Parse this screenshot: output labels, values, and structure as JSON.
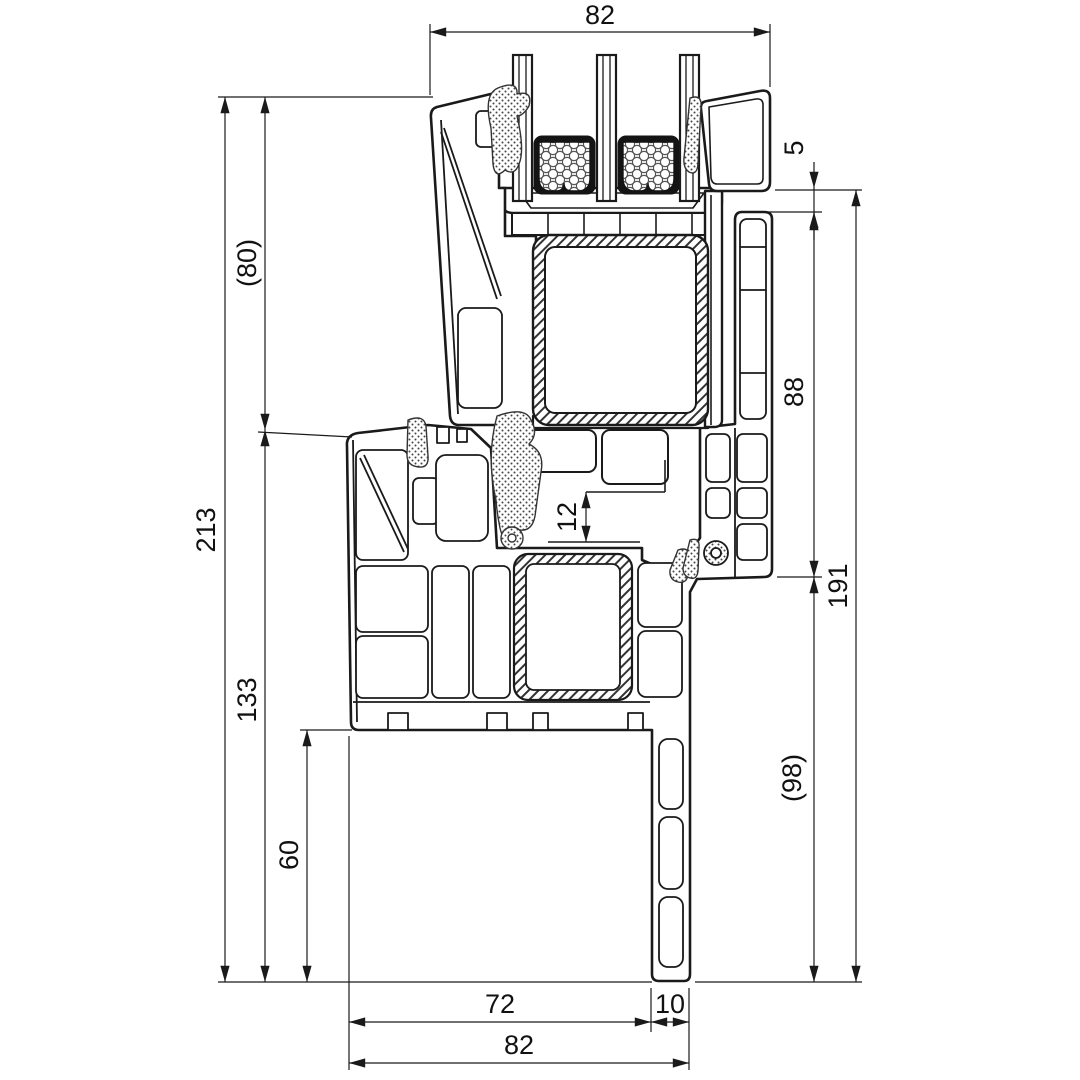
{
  "drawing": {
    "colors": {
      "line": "#1a1a1a",
      "background": "#ffffff",
      "sealant_black": "#141414",
      "hatch": "#333333"
    },
    "dimensions": {
      "top_width": "82",
      "left_height_upper": "(80)",
      "left_height_total": "213",
      "left_height_lower": "133",
      "left_height_sill": "60",
      "right_gap": "5",
      "right_height_upper": "88",
      "right_height_total": "191",
      "right_height_lower": "(98)",
      "groove_depth": "12",
      "bottom_width_frame": "72",
      "bottom_width_extension": "10",
      "bottom_width_total": "82"
    }
  }
}
